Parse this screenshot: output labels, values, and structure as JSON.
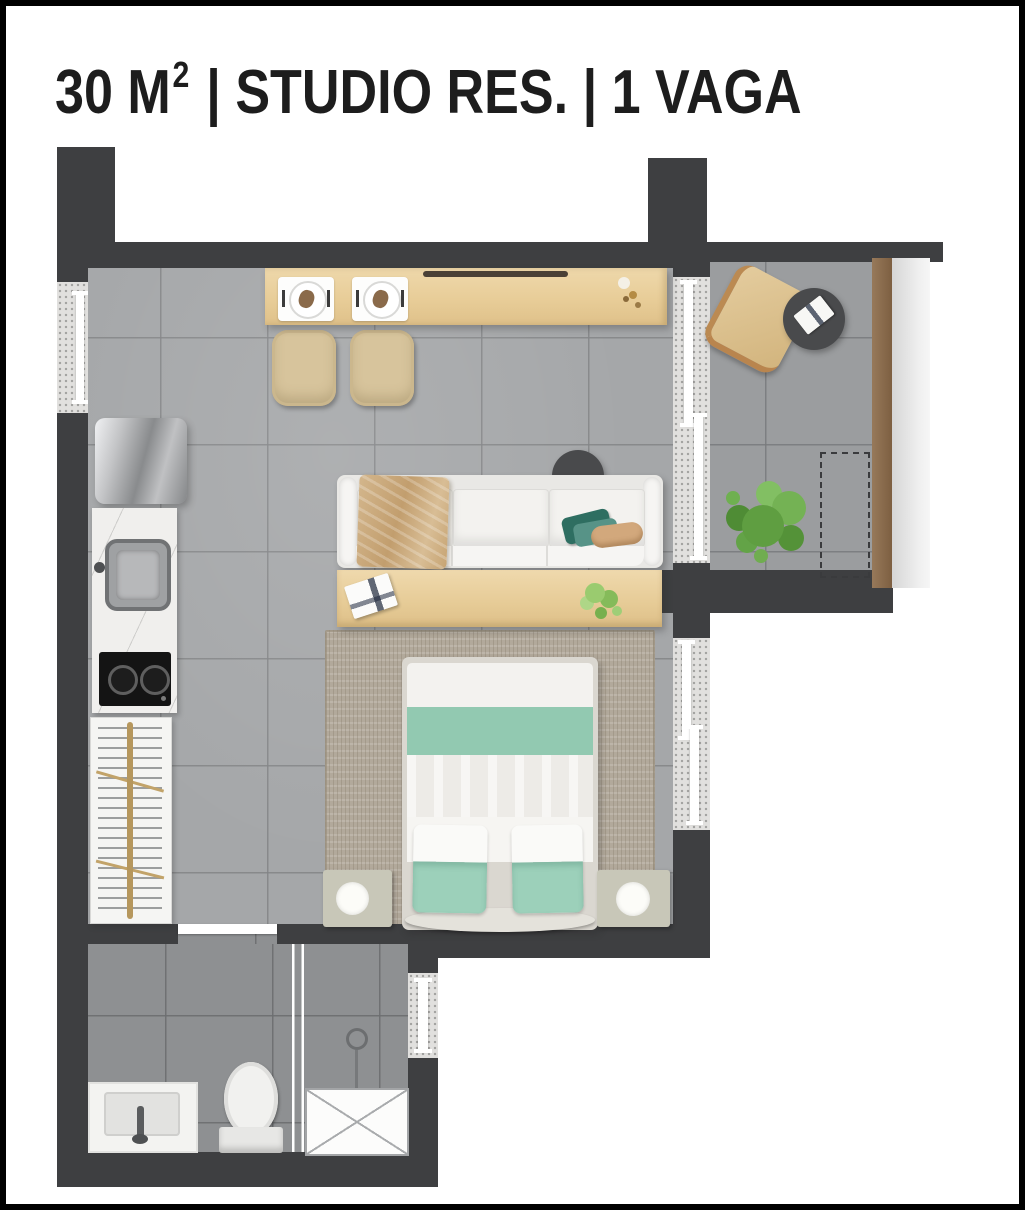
{
  "title": {
    "main": "30 M",
    "sup": "2",
    "rest": " | STUDIO RES. | 1 VAGA"
  },
  "legend": {
    "area": "30 M2",
    "unit_type": "STUDIO RES.",
    "parking": "1 VAGA"
  },
  "palette": {
    "wall": "#3e3f41",
    "floor_living": "#a5a7a9",
    "floor_bathroom": "#8e9092",
    "floor_balcony": "#9b9d9f",
    "wood_furniture": "#e8cd98",
    "sofa_white": "#f3f2ef",
    "bed_teal": "#92c9b1",
    "pillow_teal": "#9cd0ba",
    "throw_tan": "#c7a473",
    "plant_green": "#6aa84b",
    "rug_beige": "#b2a99b",
    "railing_wood": "#8c7150",
    "railing_glass": "#e2e2e2",
    "title_text": "#1d1d1d",
    "border": "#000000"
  },
  "objects": [
    "refrigerator",
    "kitchen-sink",
    "cooktop",
    "drying-rack",
    "dining-counter",
    "dining-chairs",
    "sofa",
    "side-table",
    "console-table",
    "rug",
    "double-bed",
    "nightstands",
    "lamps",
    "balcony-lounge-chair",
    "balcony-table",
    "plants",
    "planter-outline",
    "shower",
    "shower-glass",
    "toilet",
    "vanity-sink",
    "windows",
    "sliding-door"
  ]
}
